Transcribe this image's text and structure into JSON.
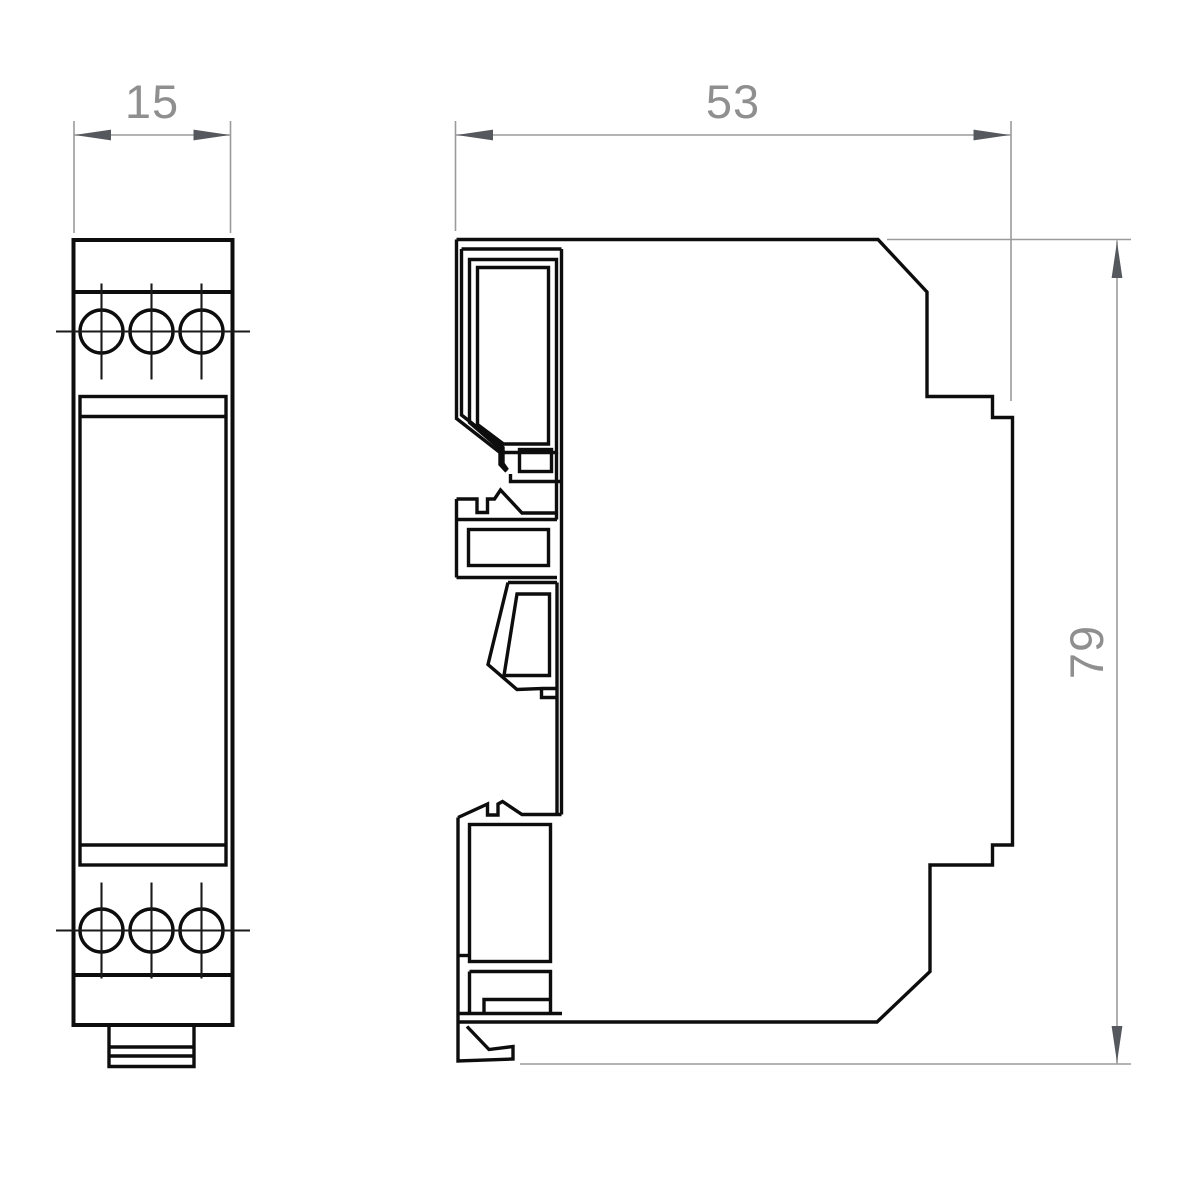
{
  "drawing": {
    "type": "technical-dimension-drawing",
    "views": {
      "front": {
        "name": "front view",
        "terminals_top": 3,
        "terminals_bottom": 3
      },
      "side": {
        "name": "side profile view"
      }
    },
    "dimensions": {
      "width": {
        "value": "15"
      },
      "depth": {
        "value": "53"
      },
      "height": {
        "value": "79"
      }
    },
    "colors": {
      "outline": "#0d0d0d",
      "centerline": "#1a1a1a",
      "dimension_line": "#9b9b9b",
      "arrow": "#55585c",
      "dimension_text": "#8f8f8f",
      "background": "#ffffff"
    }
  }
}
